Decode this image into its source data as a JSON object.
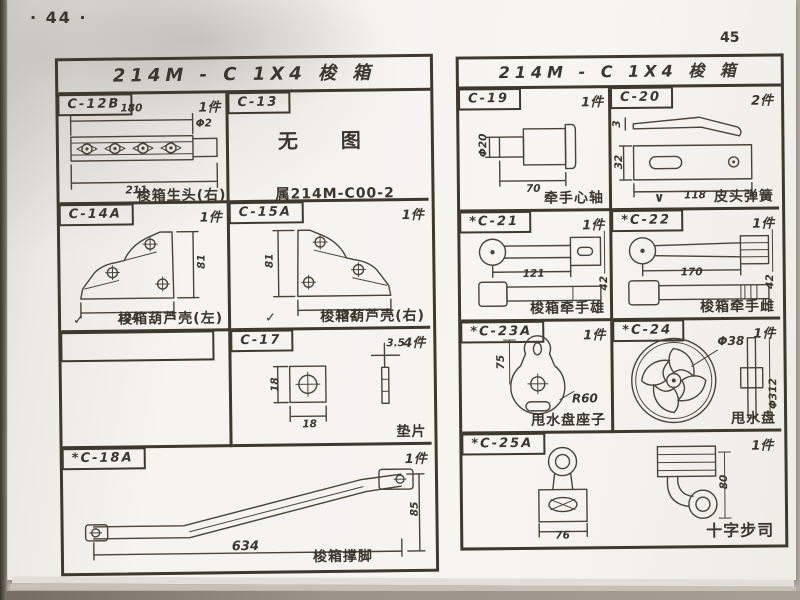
{
  "photo": {
    "left_page_number": "· 44 ·",
    "right_page_number": "45"
  },
  "left_table": {
    "title": "214M - C    1X4 梭 箱",
    "c12b": {
      "code": "C-12B",
      "count": "1件",
      "dim_top": "180",
      "dim_right": "Φ2",
      "dim_bottom": "211",
      "caption": "梭箱生头(右)"
    },
    "c13": {
      "code": "C-13",
      "no_figure": "无  图",
      "caption": "属214M-C00-2"
    },
    "c14a": {
      "code": "C-14A",
      "count": "1件",
      "dim_w": "124",
      "dim_h": "81",
      "check": "✓",
      "caption": "梭箱葫芦壳(左)"
    },
    "c15a": {
      "code": "C-15A",
      "count": "1件",
      "dim_w": "124",
      "dim_h": "81",
      "check": "✓",
      "caption": "梭箱葫芦壳(右)"
    },
    "c17": {
      "code": "C-17",
      "count": "4件",
      "dim_w": "18",
      "dim_h": "18",
      "dim_t": "3.5",
      "caption": "垫片"
    },
    "c18a": {
      "code": "*C-18A",
      "count": "1件",
      "dim_l": "634",
      "dim_h": "85",
      "caption": "梭箱撑脚"
    }
  },
  "right_table": {
    "title": "214M - C    1X4 梭 箱",
    "c19": {
      "code": "C-19",
      "count": "1件",
      "dim_d": "Φ20",
      "dim_l": "70",
      "caption": "牵手心轴"
    },
    "c20": {
      "code": "C-20",
      "count": "2件",
      "dim_t": "3",
      "dim_w": "32",
      "dim_l": "118",
      "check": "∨",
      "caption": "皮头弹簧"
    },
    "c21": {
      "code": "*C-21",
      "count": "1件",
      "dim_l": "121",
      "dim_h": "42",
      "caption": "梭箱牵手雄"
    },
    "c22": {
      "code": "*C-22",
      "count": "1件",
      "dim_l": "170",
      "dim_h": "42",
      "caption": "梭箱牵手雌"
    },
    "c23a": {
      "code": "*C-23A",
      "count": "1件",
      "dim_h": "75",
      "dim_r": "R60",
      "caption": "甩水盘座子"
    },
    "c24": {
      "code": "*C-24",
      "count": "1件",
      "dim_d1": "Φ38",
      "dim_d2": "Φ312",
      "caption": "甩水盘"
    },
    "c25a": {
      "code": "*C-25A",
      "count": "1件",
      "dim_w": "76",
      "dim_h": "80",
      "caption": "十字步司"
    }
  }
}
